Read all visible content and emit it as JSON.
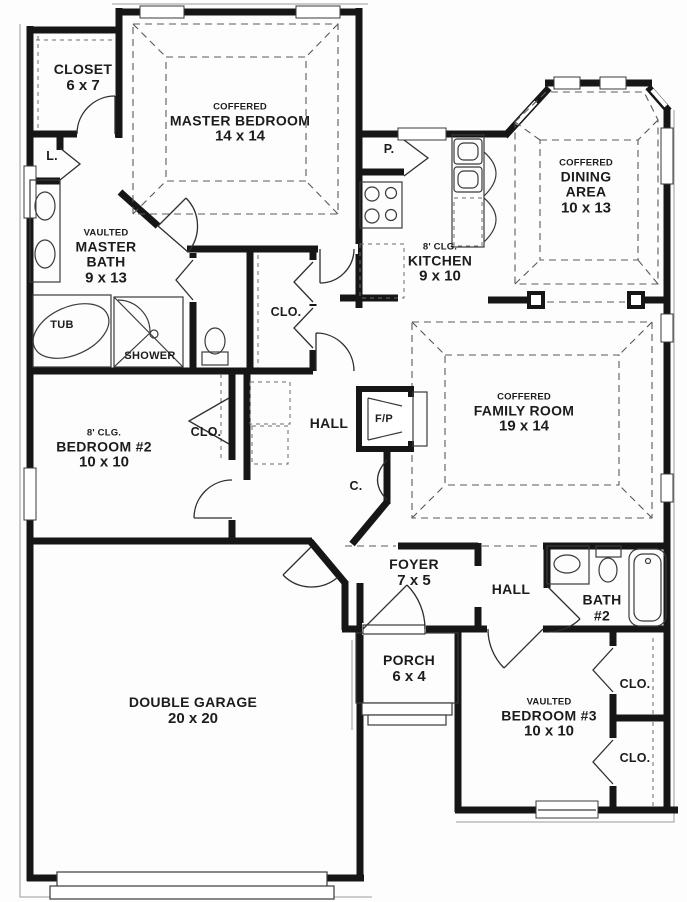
{
  "plan": {
    "rooms": {
      "master_closet": {
        "name": "CLOSET",
        "dims": "6 x 7"
      },
      "master_bedroom": {
        "note": "COFFERED",
        "name": "MASTER BEDROOM",
        "dims": "14 x 14"
      },
      "linen": {
        "name": "L."
      },
      "master_bath": {
        "note": "VAULTED",
        "name": "MASTER BATH",
        "dims": "9 x 13"
      },
      "tub": {
        "name": "TUB"
      },
      "shower": {
        "name": "SHOWER"
      },
      "pantry": {
        "name": "P."
      },
      "kitchen": {
        "note": "8' CLG.",
        "name": "KITCHEN",
        "dims": "9 x 10"
      },
      "dining": {
        "note": "COFFERED",
        "name": "DINING AREA",
        "dims": "10 x 13"
      },
      "master_clo": {
        "name": "CLO."
      },
      "hall_upper": {
        "name": "HALL"
      },
      "fireplace": {
        "name": "F/P"
      },
      "family": {
        "note": "COFFERED",
        "name": "FAMILY ROOM",
        "dims": "19 x 14"
      },
      "bedroom2": {
        "note": "8' CLG.",
        "name": "BEDROOM #2",
        "dims": "10 x 10"
      },
      "bedroom2_clo": {
        "name": "CLO."
      },
      "coat_closet": {
        "name": "C."
      },
      "foyer": {
        "name": "FOYER",
        "dims": "7 x 5"
      },
      "hall_lower": {
        "name": "HALL"
      },
      "bath2": {
        "name": "BATH #2"
      },
      "porch": {
        "name": "PORCH",
        "dims": "6 x 4"
      },
      "garage": {
        "name": "DOUBLE GARAGE",
        "dims": "20 x 20"
      },
      "bedroom3": {
        "note": "VAULTED",
        "name": "BEDROOM #3",
        "dims": "10 x 10"
      },
      "bedroom3_clo_upper": {
        "name": "CLO."
      },
      "bedroom3_clo_lower": {
        "name": "CLO."
      }
    },
    "colors": {
      "wall": "#161616",
      "line": "#3a3a3a",
      "dashed": "#5a5a5a",
      "text": "#1c1c1c",
      "bg": "#ffffff"
    }
  }
}
